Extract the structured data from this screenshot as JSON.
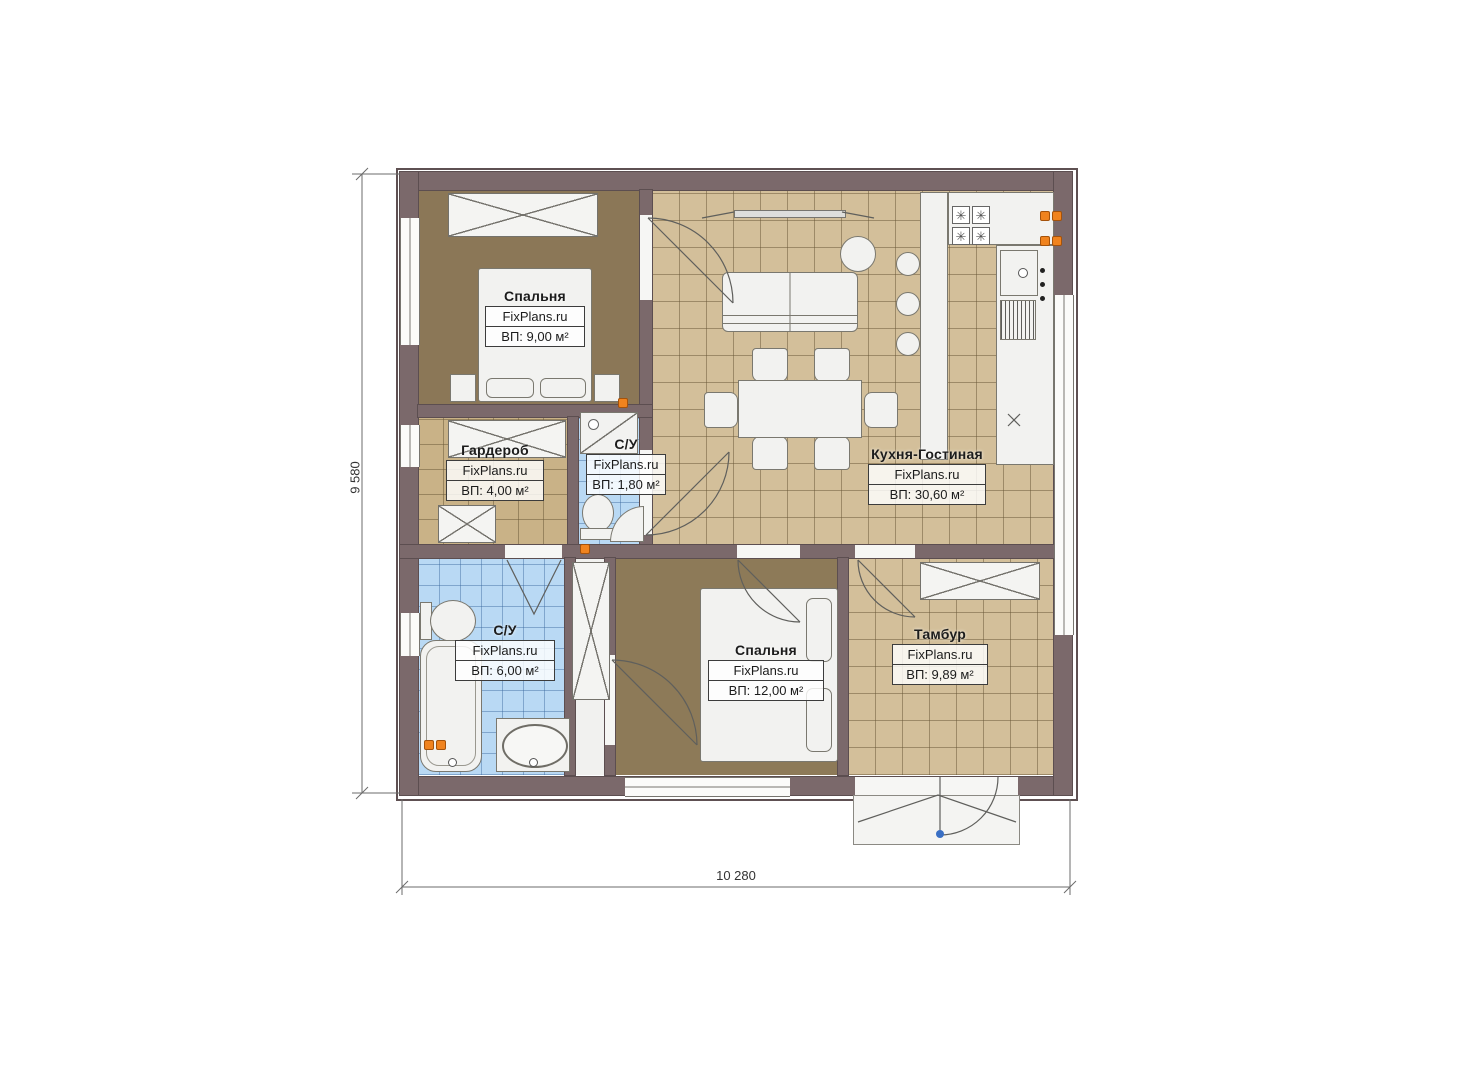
{
  "plan": {
    "type": "floor-plan",
    "watermark": "FixPlans.ru",
    "dimensions": {
      "width_label": "10 280",
      "height_label": "9 580"
    },
    "rooms": [
      {
        "id": "bedroom-top",
        "name": "Спальня",
        "brand": "FixPlans.ru",
        "area": "ВП: 9,00 м²"
      },
      {
        "id": "wardrobe-room",
        "name": "Гардероб",
        "brand": "FixPlans.ru",
        "area": "ВП: 4,00 м²"
      },
      {
        "id": "bathroom-small",
        "name": "С/У",
        "brand": "FixPlans.ru",
        "area": "ВП: 1,80 м²"
      },
      {
        "id": "kitchen-living",
        "name": "Кухня-Гостиная",
        "brand": "FixPlans.ru",
        "area": "ВП: 30,60 м²"
      },
      {
        "id": "bathroom-large",
        "name": "С/У",
        "brand": "FixPlans.ru",
        "area": "ВП: 6,00 м²"
      },
      {
        "id": "bedroom-bottom",
        "name": "Спальня",
        "brand": "FixPlans.ru",
        "area": "ВП: 12,00 м²"
      },
      {
        "id": "vestibule",
        "name": "Тамбур",
        "brand": "FixPlans.ru",
        "area": "ВП: 9,89 м²"
      }
    ],
    "colors": {
      "wall": "#7b696b",
      "tile_tan": "#d3bf9a",
      "tile_blue": "#b9d9f4",
      "carpet": "#8b7757",
      "socket_orange": "#f0831e",
      "door_handle_blue": "#3a6fc4"
    }
  }
}
